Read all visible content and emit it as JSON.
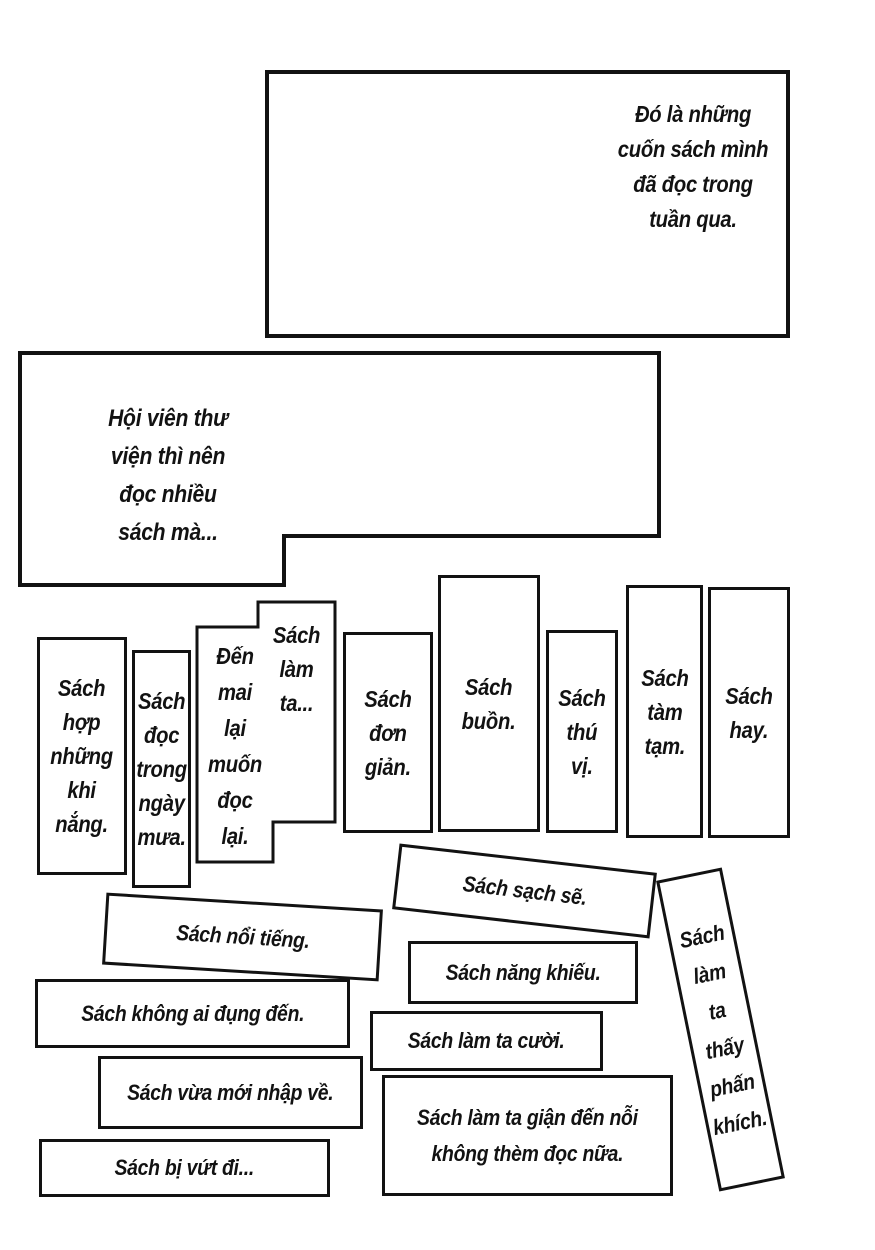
{
  "colors": {
    "background": "#ffffff",
    "ink": "#121212"
  },
  "narration": {
    "top_panel": "Đó là những\ncuốn sách mình\nđã đọc trong\ntuần qua.",
    "left_panel": "Hội viên thư\nviện thì nên\nđọc nhiều\nsách mà..."
  },
  "book_spines": [
    {
      "text": "Sách\nhợp\nnhững\nkhi\nnắng."
    },
    {
      "text": "Sách\nđọc\ntrong\nngày\nmưa."
    },
    {
      "text": "Đến\nmai\nlại\nmuốn\nđọc\nlại."
    },
    {
      "text": "Sách\nlàm\nta..."
    },
    {
      "text": "Sách\nđơn\ngiản."
    },
    {
      "text": "Sách\nbuồn."
    },
    {
      "text": "Sách\nthú\nvị."
    },
    {
      "text": "Sách\ntàm\ntạm."
    },
    {
      "text": "Sách\nhay."
    }
  ],
  "book_labels": [
    {
      "text": "Sách sạch sẽ."
    },
    {
      "text": "Sách nổi tiếng."
    },
    {
      "text": "Sách năng khiếu."
    },
    {
      "text": "Sách không ai đụng đến."
    },
    {
      "text": "Sách làm ta cười."
    },
    {
      "text": "Sách vừa mới nhập về."
    },
    {
      "text": "Sách làm ta giận đến nỗi\nkhông thèm đọc nữa."
    },
    {
      "text": "Sách bị vứt đi..."
    },
    {
      "text": "Sách\nlàm\nta\nthấy\nphấn\nkhích."
    }
  ]
}
